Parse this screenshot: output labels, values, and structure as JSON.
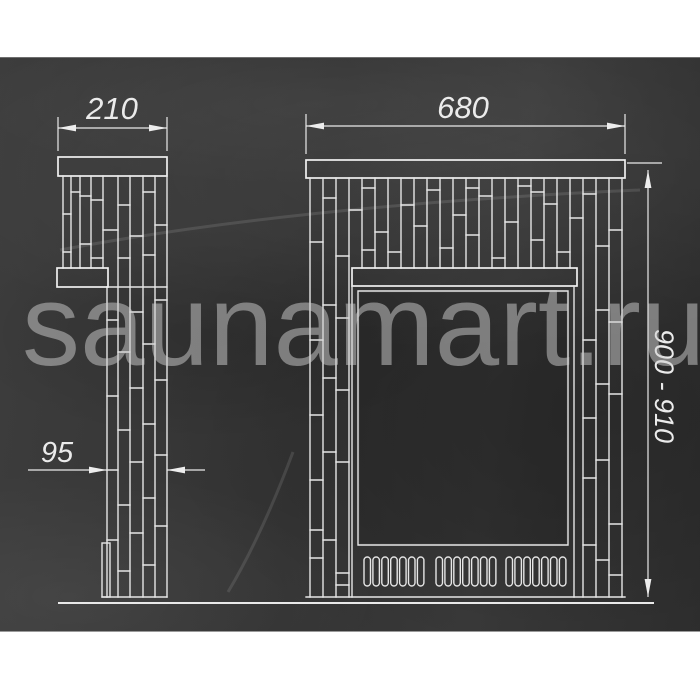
{
  "watermark": {
    "text": "saunamart.ru"
  },
  "drawing": {
    "dimensions": {
      "side_width": "210",
      "front_width": "680",
      "height_range": "900 - 910",
      "side_depth": "95"
    },
    "colors": {
      "page_band": "#ffffff",
      "panel_background": "#363636",
      "drawing_line": "#e8e8e8",
      "dimension_text": "#ebebeb",
      "watermark_gray": "#8a8a8a"
    }
  }
}
